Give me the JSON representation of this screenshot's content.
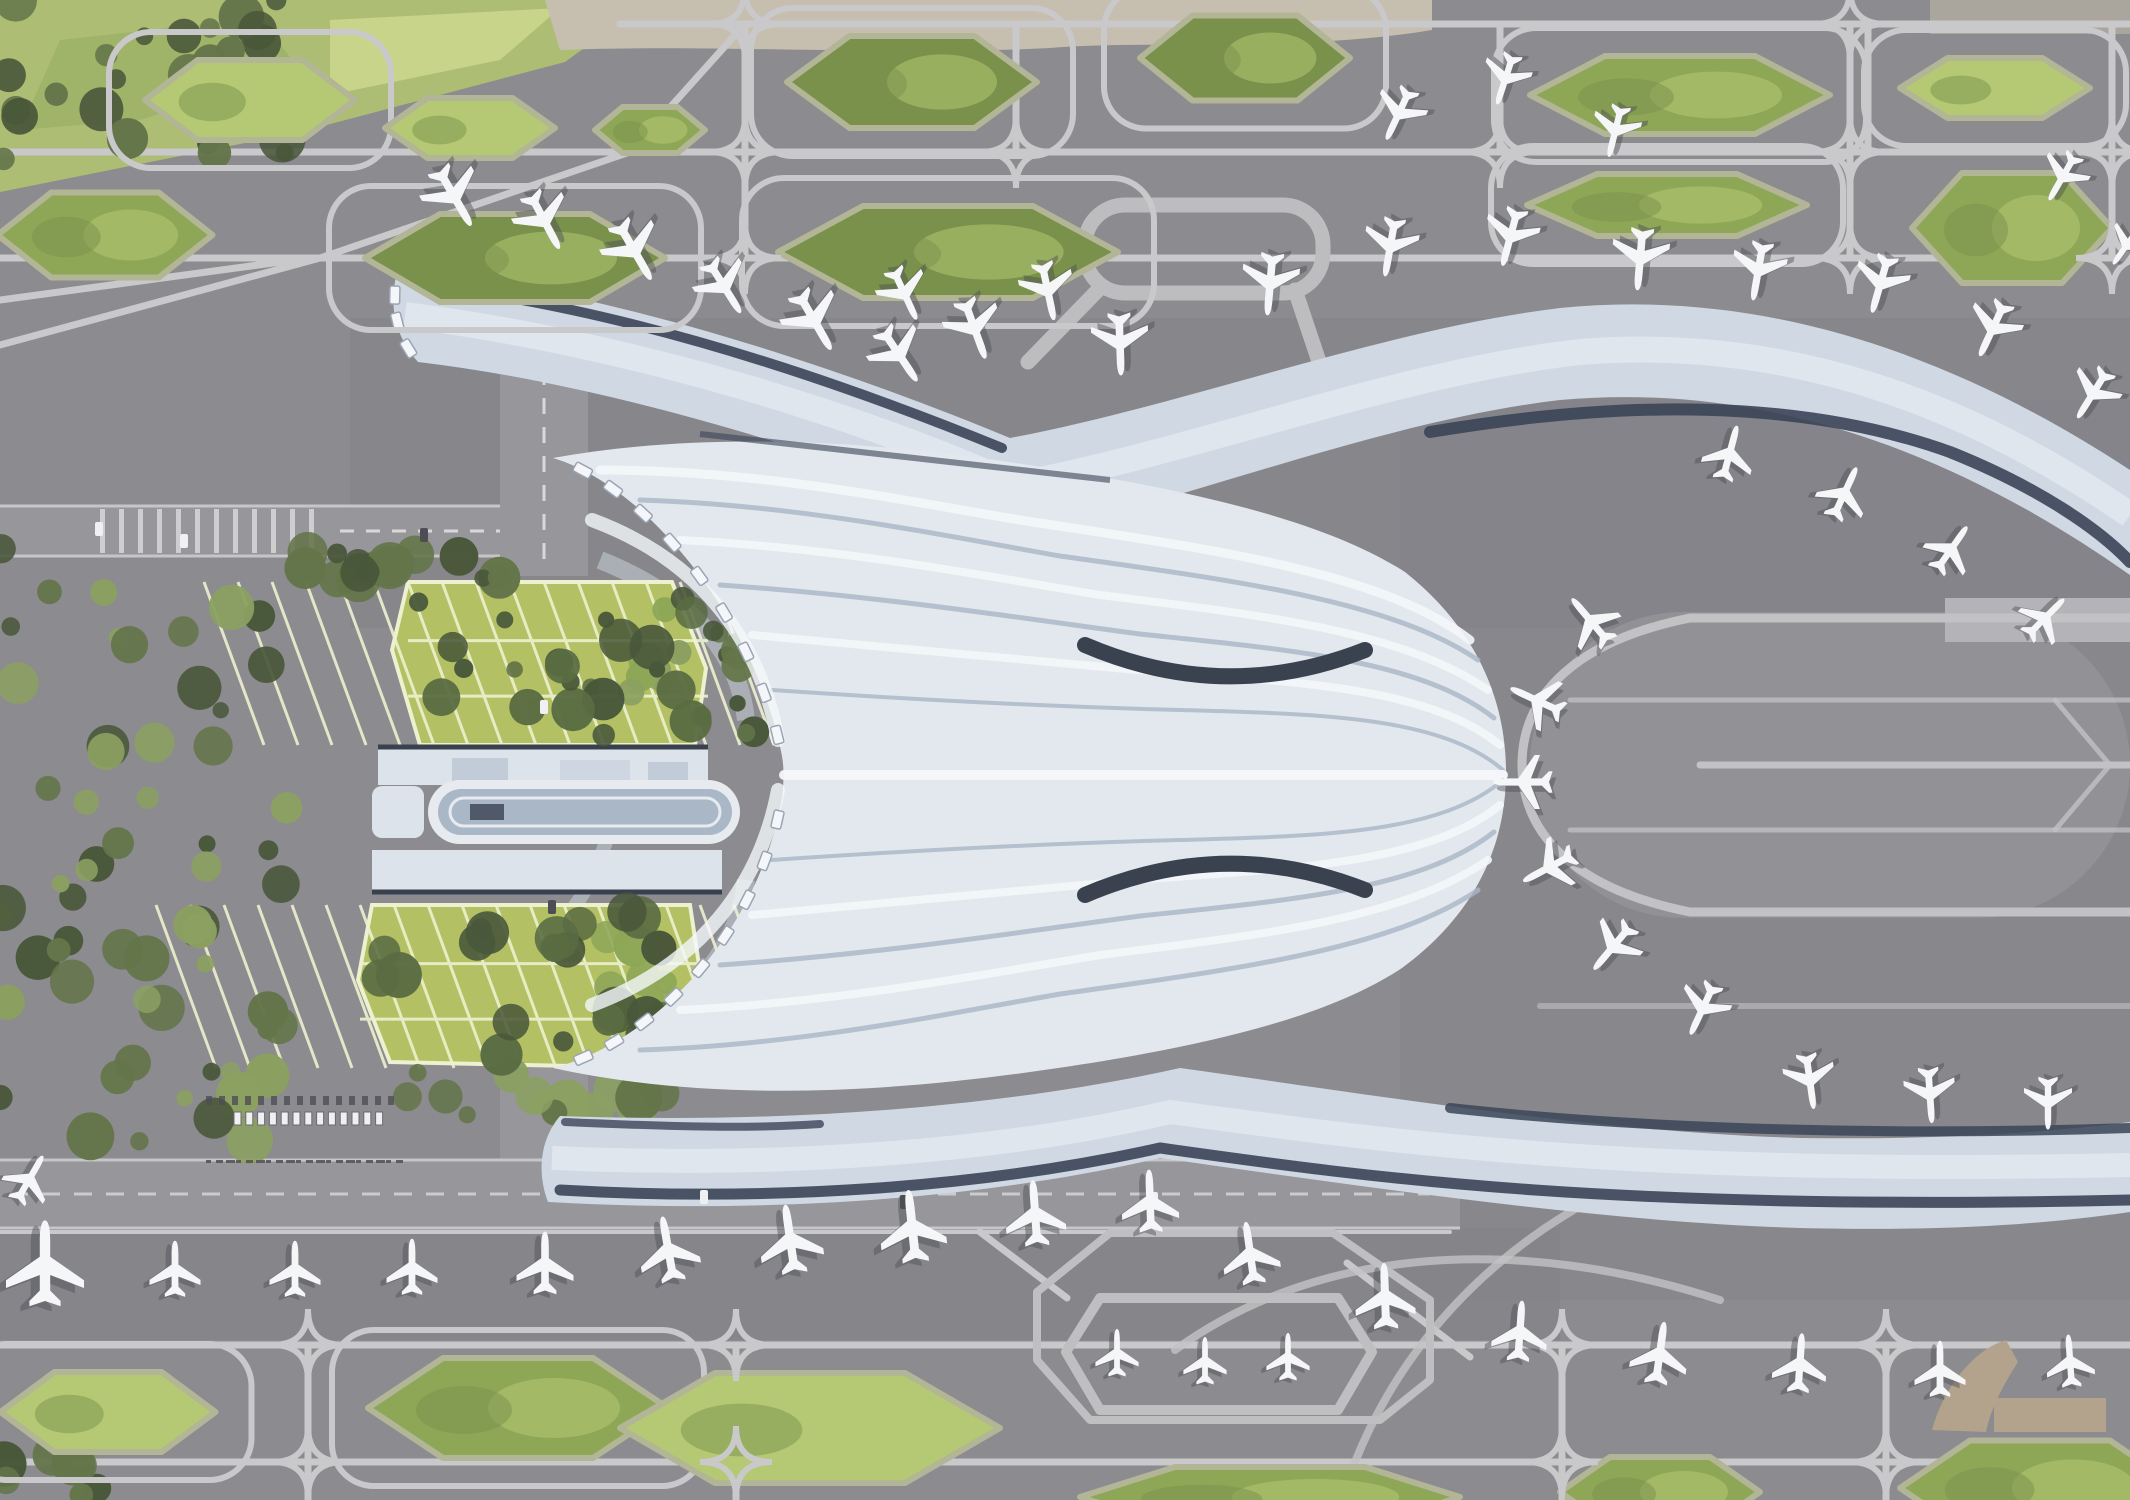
{
  "scene": {
    "description": "Aerial master-plan rendering of a butterfly-shaped airport terminal with four curved concourse piers, a C-shaped eastern apron loop, landscaped taxiway islands, green-roof parking garages, a ground transport centre and dozens of parked aircraft",
    "style": "architectural render, top-down"
  },
  "palette": {
    "tarmac": "#8c8b8f",
    "apron": "#828187",
    "cInterior": "#929196",
    "road": "#97969a",
    "laneLine": "#d8d8da",
    "latticeLine": "#c9c9cb",
    "runwayBand": "#b4b3b7",
    "islandRim": "#b2b596",
    "islandDark": "#79914b",
    "islandMid": "#8ea757",
    "islandLight": "#b5c873",
    "treeDark": "#49573a",
    "treeMid": "#64754a",
    "treeLight": "#8ba061",
    "grass": "#aebd74",
    "grassLight": "#cdd98f",
    "parkingGreen": "#b3c164",
    "parkingLine": "#edf1cf",
    "beige": "#c6beaf",
    "tan": "#b3a38c",
    "roofBase": "#e3e8ef",
    "roofHi": "#f4f7fa",
    "roofShade": "#a9b5c6",
    "pierRoof": "#cfd8e3",
    "pierDark": "#3a4557",
    "slab": "#dde3eb",
    "ovalGlass": "#a9b7c7",
    "planeWhite": "#f5f6f8",
    "planeShadow": "#4e4d55"
  },
  "aircraft": [
    {
      "x": 455,
      "y": 198,
      "r": 150,
      "s": 1.0
    },
    {
      "x": 545,
      "y": 222,
      "r": 152,
      "s": 0.95
    },
    {
      "x": 635,
      "y": 252,
      "r": 150,
      "s": 1.0
    },
    {
      "x": 725,
      "y": 288,
      "r": 148,
      "s": 0.92
    },
    {
      "x": 815,
      "y": 322,
      "r": 150,
      "s": 1.0
    },
    {
      "x": 900,
      "y": 356,
      "r": 146,
      "s": 0.95
    },
    {
      "x": 905,
      "y": 295,
      "r": 155,
      "s": 0.85
    },
    {
      "x": 975,
      "y": 330,
      "r": 160,
      "s": 0.95
    },
    {
      "x": 1048,
      "y": 292,
      "r": 168,
      "s": 0.9
    },
    {
      "x": 1120,
      "y": 345,
      "r": 178,
      "s": 0.95
    },
    {
      "x": 1270,
      "y": 285,
      "r": 185,
      "s": 0.95
    },
    {
      "x": 1390,
      "y": 248,
      "r": 190,
      "s": 0.9
    },
    {
      "x": 1510,
      "y": 238,
      "r": 195,
      "s": 0.9
    },
    {
      "x": 1640,
      "y": 260,
      "r": 185,
      "s": 0.95
    },
    {
      "x": 1758,
      "y": 272,
      "r": 190,
      "s": 0.9
    },
    {
      "x": 1880,
      "y": 285,
      "r": 196,
      "s": 0.9
    },
    {
      "x": 1992,
      "y": 330,
      "r": 205,
      "s": 0.9
    },
    {
      "x": 2092,
      "y": 395,
      "r": 212,
      "s": 0.85
    },
    {
      "x": 1398,
      "y": 115,
      "r": 205,
      "s": 0.85
    },
    {
      "x": 1505,
      "y": 80,
      "r": 198,
      "s": 0.8
    },
    {
      "x": 1615,
      "y": 132,
      "r": 194,
      "s": 0.8
    },
    {
      "x": 2062,
      "y": 178,
      "r": 210,
      "s": 0.8
    },
    {
      "x": 2126,
      "y": 246,
      "r": 215,
      "s": 0.7
    },
    {
      "x": 1730,
      "y": 452,
      "r": 15,
      "s": 0.85
    },
    {
      "x": 1845,
      "y": 492,
      "r": 25,
      "s": 0.85
    },
    {
      "x": 1952,
      "y": 548,
      "r": 35,
      "s": 0.82
    },
    {
      "x": 2046,
      "y": 617,
      "r": 45,
      "s": 0.8
    },
    {
      "x": 1590,
      "y": 620,
      "r": -40,
      "s": 0.88
    },
    {
      "x": 1536,
      "y": 700,
      "r": -65,
      "s": 0.88
    },
    {
      "x": 1522,
      "y": 782,
      "r": -90,
      "s": 0.9
    },
    {
      "x": 1548,
      "y": 868,
      "r": -118,
      "s": 0.88
    },
    {
      "x": 1612,
      "y": 948,
      "r": -140,
      "s": 0.88
    },
    {
      "x": 1702,
      "y": 1010,
      "r": -155,
      "s": 0.85
    },
    {
      "x": 1810,
      "y": 1082,
      "r": 172,
      "s": 0.85
    },
    {
      "x": 1930,
      "y": 1096,
      "r": 176,
      "s": 0.85
    },
    {
      "x": 2048,
      "y": 1104,
      "r": 180,
      "s": 0.8
    },
    {
      "x": 1250,
      "y": 1252,
      "r": -8,
      "s": 0.95
    },
    {
      "x": 1385,
      "y": 1295,
      "r": -2,
      "s": 1.0
    },
    {
      "x": 1520,
      "y": 1330,
      "r": 4,
      "s": 0.92
    },
    {
      "x": 1660,
      "y": 1352,
      "r": 8,
      "s": 0.95
    },
    {
      "x": 1800,
      "y": 1362,
      "r": 4,
      "s": 0.9
    },
    {
      "x": 1940,
      "y": 1368,
      "r": 0,
      "s": 0.85
    },
    {
      "x": 2070,
      "y": 1360,
      "r": -4,
      "s": 0.8
    },
    {
      "x": 45,
      "y": 1262,
      "r": 0,
      "s": 1.3
    },
    {
      "x": 175,
      "y": 1268,
      "r": 0,
      "s": 0.85
    },
    {
      "x": 295,
      "y": 1268,
      "r": 0,
      "s": 0.85
    },
    {
      "x": 412,
      "y": 1266,
      "r": 0,
      "s": 0.85
    },
    {
      "x": 545,
      "y": 1262,
      "r": 0,
      "s": 0.95
    },
    {
      "x": 668,
      "y": 1248,
      "r": -10,
      "s": 1.0
    },
    {
      "x": 790,
      "y": 1238,
      "r": -8,
      "s": 1.05
    },
    {
      "x": 912,
      "y": 1225,
      "r": -6,
      "s": 1.1
    },
    {
      "x": 1035,
      "y": 1212,
      "r": -4,
      "s": 1.0
    },
    {
      "x": 1150,
      "y": 1200,
      "r": -2,
      "s": 0.95
    },
    {
      "x": 30,
      "y": 1178,
      "r": 30,
      "s": 0.8
    },
    {
      "x": 1117,
      "y": 1352,
      "r": 0,
      "s": 0.72
    },
    {
      "x": 1205,
      "y": 1360,
      "r": 0,
      "s": 0.72
    },
    {
      "x": 1288,
      "y": 1356,
      "r": 0,
      "s": 0.72
    }
  ],
  "islands": [
    {
      "cx": 250,
      "cy": 100,
      "w": 210,
      "h": 80,
      "tone": "light",
      "cell": true
    },
    {
      "cx": 470,
      "cy": 128,
      "w": 170,
      "h": 60,
      "tone": "light",
      "cell": false
    },
    {
      "cx": 650,
      "cy": 130,
      "w": 110,
      "h": 46,
      "tone": "mid",
      "cell": false
    },
    {
      "cx": 912,
      "cy": 82,
      "w": 250,
      "h": 92,
      "tone": "dark",
      "cell": true
    },
    {
      "cx": 1245,
      "cy": 58,
      "w": 210,
      "h": 85,
      "tone": "dark",
      "cell": true
    },
    {
      "cx": 1680,
      "cy": 95,
      "w": 300,
      "h": 78,
      "tone": "mid",
      "cell": true
    },
    {
      "cx": 1995,
      "cy": 88,
      "w": 190,
      "h": 60,
      "tone": "light",
      "cell": true
    },
    {
      "cx": 105,
      "cy": 235,
      "w": 215,
      "h": 85,
      "tone": "mid",
      "cell": false
    },
    {
      "cx": 515,
      "cy": 258,
      "w": 300,
      "h": 88,
      "tone": "dark",
      "cell": true
    },
    {
      "cx": 948,
      "cy": 252,
      "w": 340,
      "h": 92,
      "tone": "dark",
      "cell": true
    },
    {
      "cx": 1667,
      "cy": 205,
      "w": 280,
      "h": 62,
      "tone": "mid",
      "cell": true
    },
    {
      "cx": 2012,
      "cy": 228,
      "w": 200,
      "h": 110,
      "tone": "mid",
      "cell": false
    },
    {
      "cx": 108,
      "cy": 1412,
      "w": 215,
      "h": 80,
      "tone": "light",
      "cell": true
    },
    {
      "cx": 518,
      "cy": 1408,
      "w": 300,
      "h": 100,
      "tone": "mid",
      "cell": true
    },
    {
      "cx": 810,
      "cy": 1428,
      "w": 380,
      "h": 110,
      "tone": "light",
      "cell": false
    },
    {
      "cx": 1270,
      "cy": 1497,
      "w": 380,
      "h": 60,
      "tone": "mid",
      "cell": false
    },
    {
      "cx": 1660,
      "cy": 1492,
      "w": 200,
      "h": 70,
      "tone": "mid",
      "cell": false
    },
    {
      "cx": 2040,
      "cy": 1488,
      "w": 280,
      "h": 95,
      "tone": "mid",
      "cell": false
    }
  ],
  "vehicles": {
    "busRow": {
      "x0": 234,
      "y": 1112,
      "count": 13,
      "dx": 11.8,
      "w": 7,
      "h": 13
    },
    "carRow": {
      "x0": 206,
      "y": 1096,
      "count": 15,
      "dx": 13,
      "w": 6,
      "h": 9
    },
    "roadDashes": {
      "x0": 206,
      "y": 1160,
      "count": 20,
      "dx": 10
    },
    "cars": [
      [
        95,
        522,
        "w"
      ],
      [
        180,
        534,
        "w"
      ],
      [
        420,
        528,
        "d"
      ],
      [
        540,
        700,
        "w"
      ],
      [
        548,
        900,
        "d"
      ],
      [
        700,
        1190,
        "w"
      ],
      [
        900,
        1195,
        "d"
      ],
      [
        1150,
        1192,
        "w"
      ]
    ]
  },
  "counts": {
    "aircraft_total": 57,
    "green_islands": 18,
    "concourse_piers": 4
  }
}
